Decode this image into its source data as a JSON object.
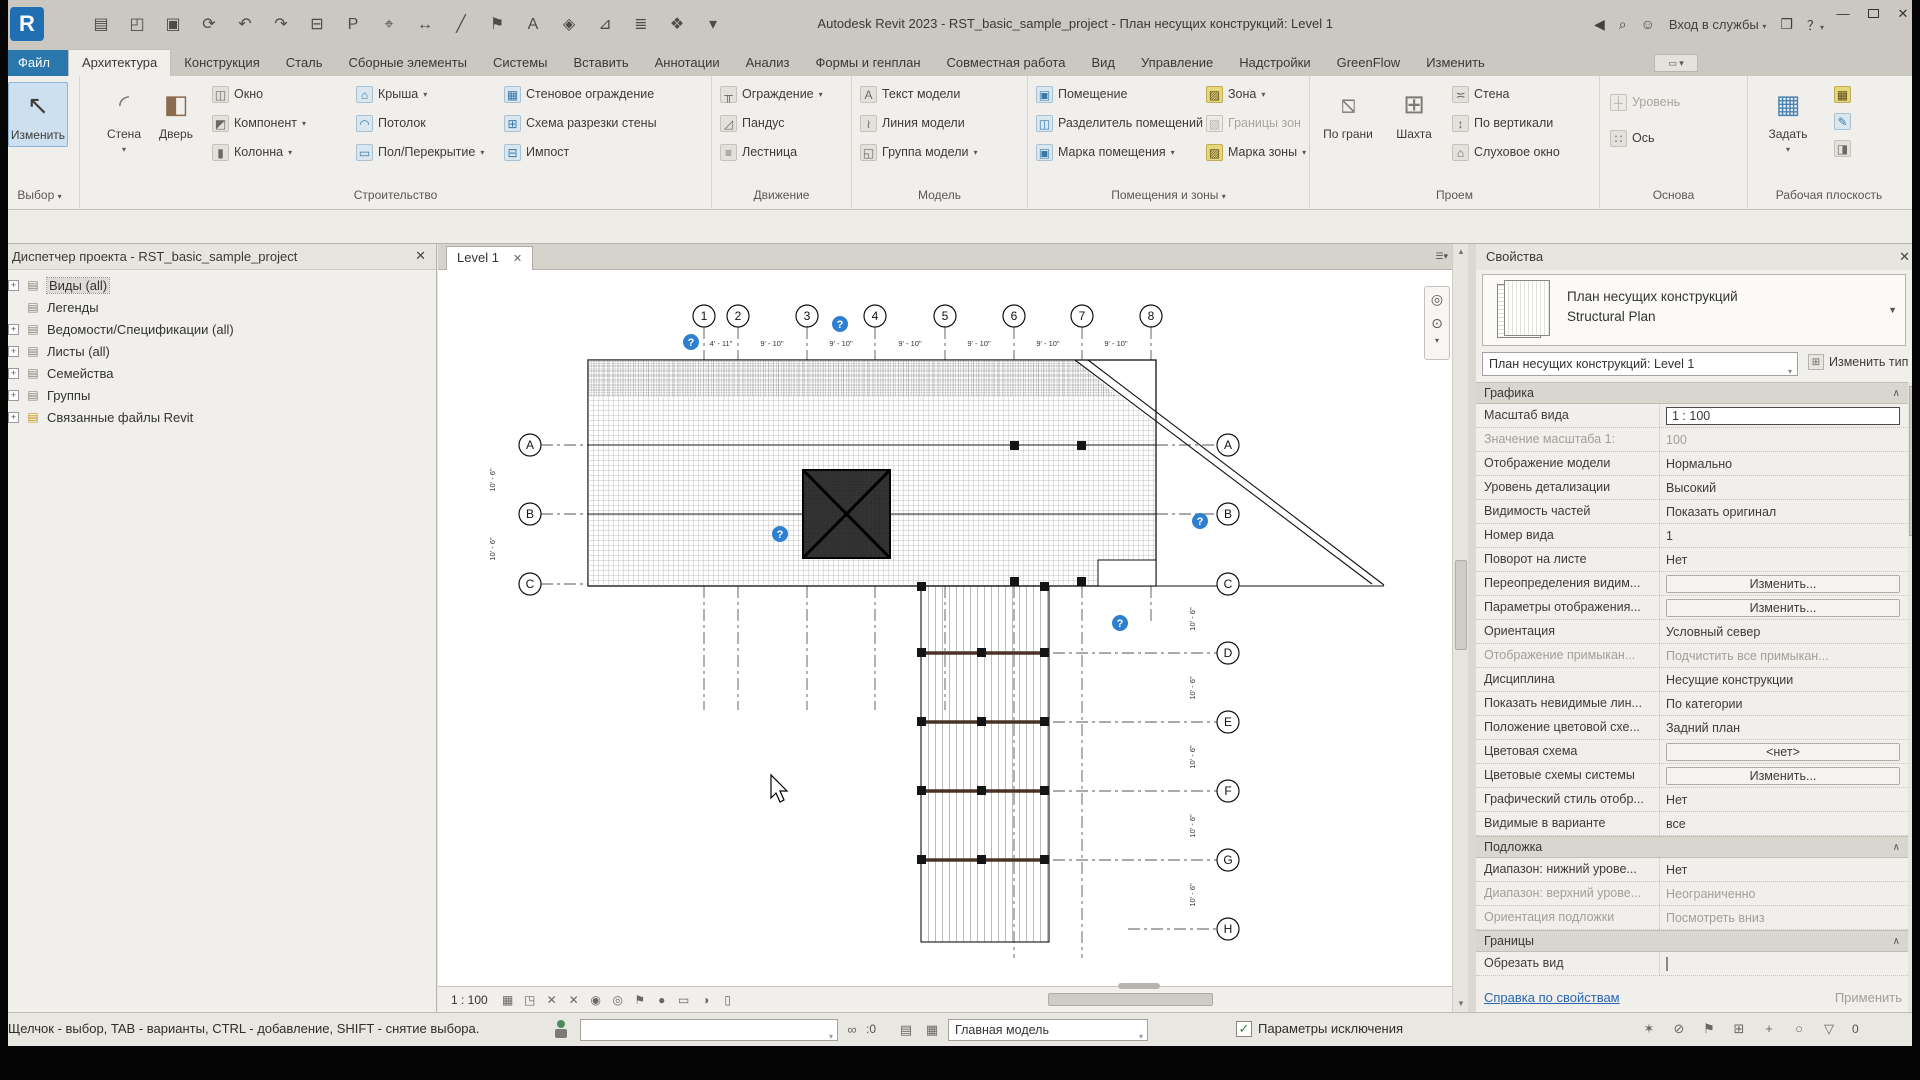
{
  "titlebar": {
    "title": "Autodesk Revit 2023 - RST_basic_sample_project - План несущих конструкций: Level 1",
    "signin": "Вход в службы",
    "logo": "R"
  },
  "qat_icons": [
    "▤",
    "◰",
    "▣",
    "⟳",
    "↶",
    "↷",
    "⊟",
    "P",
    "⌖",
    "↔",
    "╱",
    "⚑",
    "A",
    "◈",
    "⊿",
    "≣",
    "❖",
    "▾"
  ],
  "tabs": [
    {
      "label": "Файл",
      "cls": "file"
    },
    {
      "label": "Архитектура",
      "cls": "active"
    },
    {
      "label": "Конструкция",
      "cls": ""
    },
    {
      "label": "Сталь",
      "cls": ""
    },
    {
      "label": "Сборные элементы",
      "cls": ""
    },
    {
      "label": "Системы",
      "cls": ""
    },
    {
      "label": "Вставить",
      "cls": ""
    },
    {
      "label": "Аннотации",
      "cls": ""
    },
    {
      "label": "Анализ",
      "cls": ""
    },
    {
      "label": "Формы и генплан",
      "cls": ""
    },
    {
      "label": "Совместная работа",
      "cls": ""
    },
    {
      "label": "Вид",
      "cls": ""
    },
    {
      "label": "Управление",
      "cls": ""
    },
    {
      "label": "Надстройки",
      "cls": ""
    },
    {
      "label": "GreenFlow",
      "cls": ""
    },
    {
      "label": "Изменить",
      "cls": ""
    }
  ],
  "ribbon": {
    "modify": "Изменить",
    "select_label": "Выбор",
    "build_label": "Строительство",
    "wall": "Стена",
    "door": "Дверь",
    "window": "Окно",
    "component": "Компонент",
    "column": "Колонна",
    "roof": "Крыша",
    "ceiling": "Потолок",
    "floor": "Пол/Перекрытие",
    "curtain_wall": "Стеновое ограждение",
    "curtain_grid": "Схема разрезки стены",
    "mullion": "Импост",
    "circ_label": "Движение",
    "railing": "Ограждение",
    "ramp": "Пандус",
    "stair": "Лестница",
    "model_label": "Модель",
    "model_text": "Текст модели",
    "model_line": "Линия модели",
    "model_group": "Группа модели",
    "room_label": "Помещения и зоны",
    "room": "Помещение",
    "room_sep": "Разделитель помещений",
    "room_tag": "Марка помещения",
    "area": "Зона",
    "area_bound": "Границы зон",
    "area_tag": "Марка зоны",
    "opening_label": "Проем",
    "by_face": "По грани",
    "shaft": "Шахта",
    "wall_opening": "Стена",
    "vertical": "По вертикали",
    "dormer": "Слуховое окно",
    "datum_label": "Основа",
    "level": "Уровень",
    "grid": "Ось",
    "wp_label": "Рабочая плоскость",
    "set_wp": "Задать"
  },
  "browser": {
    "title": "Диспетчер проекта - RST_basic_sample_project",
    "items": [
      {
        "label": "Виды (all)",
        "cls": "sel",
        "exp": "+"
      },
      {
        "label": "Легенды",
        "cls": "noexp",
        "exp": ""
      },
      {
        "label": "Ведомости/Спецификации (all)",
        "cls": "",
        "exp": "+"
      },
      {
        "label": "Листы (all)",
        "cls": "",
        "exp": "+"
      },
      {
        "label": "Семейства",
        "cls": "",
        "exp": "+"
      },
      {
        "label": "Группы",
        "cls": "",
        "exp": "+"
      },
      {
        "label": "Связанные файлы Revit",
        "cls": "links",
        "exp": "+"
      }
    ]
  },
  "viewtab": {
    "label": "Level 1"
  },
  "viewbar": {
    "scale": "1 : 100",
    "icons": [
      "▦",
      "◳",
      "✕",
      "✕",
      "◉",
      "◎",
      "⚑",
      "●",
      "▭",
      "◑",
      "▯"
    ]
  },
  "drawing": {
    "grid_top": [
      "1",
      "2",
      "3",
      "4",
      "5",
      "6",
      "7",
      "8"
    ],
    "grid_left": [
      "A",
      "B",
      "C"
    ],
    "grid_right": [
      "A",
      "B",
      "C",
      "D",
      "E",
      "F",
      "G",
      "H"
    ],
    "dim_a": "9' - 10\"",
    "dim_b": "4' - 11\"",
    "dim_v": "10' - 6\"",
    "marker": "?"
  },
  "properties": {
    "header": "Свойства",
    "type_name": "План несущих конструкций",
    "type_sub": "Structural Plan",
    "selector": "План несущих конструкций: Level 1",
    "edit_type": "Изменить тип",
    "graphics_title": "Графика",
    "graphics_rows": [
      {
        "label": "Масштаб вида",
        "value": "1 : 100",
        "cls": "input"
      },
      {
        "label": "Значение масштаба    1:",
        "value": "100",
        "cls": "gray"
      },
      {
        "label": "Отображение модели",
        "value": "Нормально",
        "cls": ""
      },
      {
        "label": "Уровень детализации",
        "value": "Высокий",
        "cls": ""
      },
      {
        "label": "Видимость частей",
        "value": "Показать оригинал",
        "cls": ""
      },
      {
        "label": "Номер вида",
        "value": "1",
        "cls": ""
      },
      {
        "label": "Поворот на листе",
        "value": "Нет",
        "cls": ""
      },
      {
        "label": "Переопределения видим...",
        "value": "Изменить...",
        "cls": "btn"
      },
      {
        "label": "Параметры отображения...",
        "value": "Изменить...",
        "cls": "btn"
      },
      {
        "label": "Ориентация",
        "value": "Условный север",
        "cls": ""
      },
      {
        "label": "Отображение примыкан...",
        "value": "Подчистить все примыкан...",
        "cls": "gray"
      },
      {
        "label": "Дисциплина",
        "value": "Несущие конструкции",
        "cls": ""
      },
      {
        "label": "Показать невидимые лин...",
        "value": "По категории",
        "cls": ""
      },
      {
        "label": "Положение цветовой схе...",
        "value": "Задний план",
        "cls": ""
      },
      {
        "label": "Цветовая схема",
        "value": "<нет>",
        "cls": "btn"
      },
      {
        "label": "Цветовые схемы системы",
        "value": "Изменить...",
        "cls": "btn"
      },
      {
        "label": "Графический стиль отобр...",
        "value": "Нет",
        "cls": ""
      },
      {
        "label": "Видимые в варианте",
        "value": "все",
        "cls": ""
      }
    ],
    "underlay_title": "Подложка",
    "underlay_rows": [
      {
        "label": "Диапазон: нижний урове...",
        "value": "Нет",
        "cls": ""
      },
      {
        "label": "Диапазон: верхний урове...",
        "value": "Неограниченно",
        "cls": "gray"
      },
      {
        "label": "Ориентация подложки",
        "value": "Посмотреть вниз",
        "cls": "gray"
      }
    ],
    "extents_title": "Границы",
    "crop_label": "Обрезать вид",
    "help": "Справка по свойствам",
    "apply": "Применить"
  },
  "statusbar": {
    "hint": "Щелчок - выбор, TAB - варианты, CTRL - добавление, SHIFT - снятие выбора.",
    "zero": ":0",
    "model": "Главная модель",
    "excl": "Параметры исключения",
    "check": "✓",
    "right_icons": [
      "✶",
      "⊘",
      "⚑",
      "⊞",
      "+",
      "○",
      "▽"
    ],
    "filter_count": "0"
  }
}
